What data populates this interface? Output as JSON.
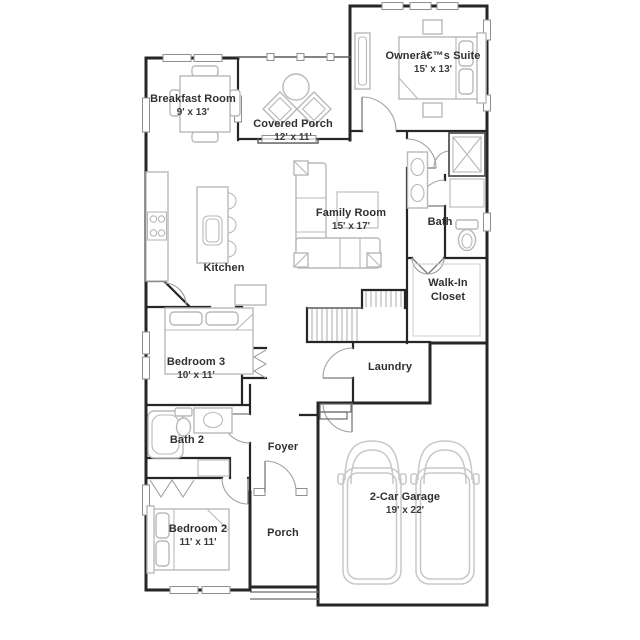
{
  "plan": {
    "title": "Single-story floor plan",
    "colors": {
      "wall": "#262626",
      "furniture": "#b8b8b8",
      "window": "#8f8f8f",
      "door": "#a0a0a0",
      "car": "#c8c8c8",
      "stair": "#ababab",
      "text": "#303030"
    },
    "rooms": [
      {
        "id": "owners-suite",
        "name": "Ownerâ€™s Suite",
        "dims": "15' x 13'"
      },
      {
        "id": "breakfast-room",
        "name": "Breakfast Room",
        "dims": "9' x 13'"
      },
      {
        "id": "covered-porch",
        "name": "Covered Porch",
        "dims": "12' x 11'"
      },
      {
        "id": "family-room",
        "name": "Family Room",
        "dims": "15' x 17'"
      },
      {
        "id": "bath",
        "name": "Bath",
        "dims": ""
      },
      {
        "id": "kitchen",
        "name": "Kitchen",
        "dims": ""
      },
      {
        "id": "walk-in-closet",
        "name": "Walk-In Closet",
        "dims": ""
      },
      {
        "id": "bedroom-3",
        "name": "Bedroom 3",
        "dims": "10' x 11'"
      },
      {
        "id": "laundry",
        "name": "Laundry",
        "dims": ""
      },
      {
        "id": "bath-2",
        "name": "Bath 2",
        "dims": ""
      },
      {
        "id": "foyer",
        "name": "Foyer",
        "dims": ""
      },
      {
        "id": "bedroom-2",
        "name": "Bedroom 2",
        "dims": "11' x 11'"
      },
      {
        "id": "porch",
        "name": "Porch",
        "dims": ""
      },
      {
        "id": "garage",
        "name": "2-Car Garage",
        "dims": "19' x 22'"
      }
    ]
  }
}
